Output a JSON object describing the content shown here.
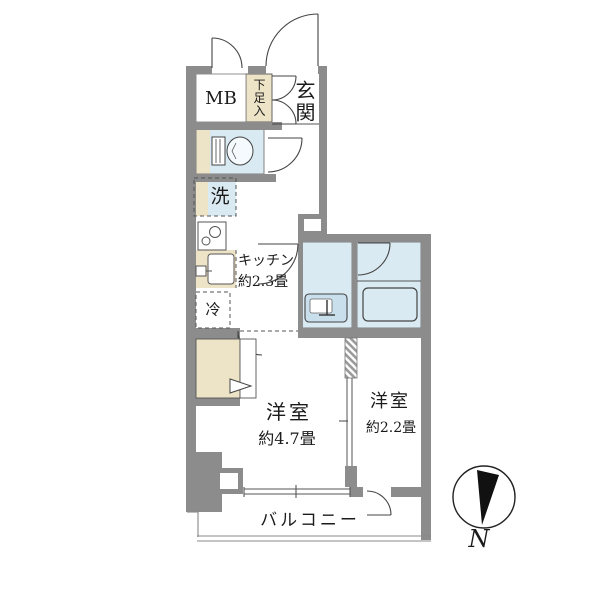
{
  "plan": {
    "meter_box": "MB",
    "shoe_cabinet": "下足入",
    "entrance": "玄関",
    "washer": "洗",
    "kitchen_name": "キッチン",
    "kitchen_size": "約2.3畳",
    "fridge": "冷",
    "main_room_name": "洋室",
    "main_room_size": "約4.7畳",
    "sub_room_name": "洋室",
    "sub_room_size": "約2.2畳",
    "balcony": "バルコニー"
  },
  "compass": {
    "north_label": "N"
  },
  "icons": {
    "toilet": "toilet-icon",
    "bathtub": "bathtub-icon",
    "washbasin": "washbasin-icon",
    "stove": "stove-icon",
    "kitchen_sink": "kitchen-sink-icon",
    "compass": "compass-north-icon"
  },
  "colors": {
    "wall": "#8c8c8c",
    "wet_area_fill": "#d9eaf2",
    "storage_fill": "#ede3c6",
    "fixture_line": "#444444",
    "background": "#ffffff"
  }
}
